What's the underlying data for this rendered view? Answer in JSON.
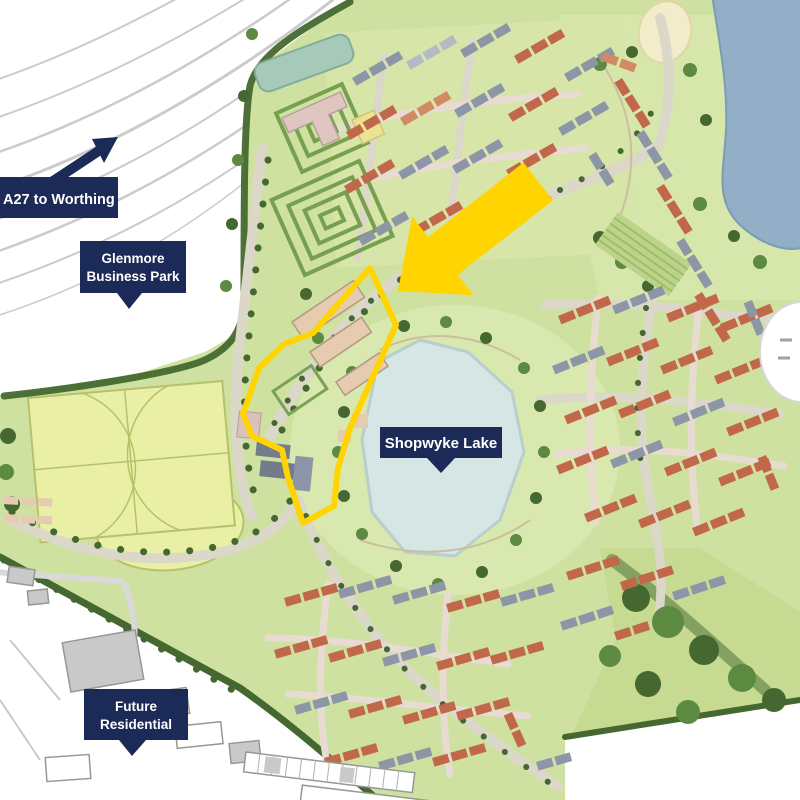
{
  "map": {
    "labels": {
      "a27": {
        "text": "A27 to Worthing"
      },
      "glenmore": {
        "line1": "Glenmore",
        "line2": "Business Park"
      },
      "shopwyke": {
        "text": "Shopwyke Lake"
      },
      "future": {
        "line1": "Future",
        "line2": "Residential"
      }
    },
    "markers": {
      "direction_arrow": "navy-arrow-northeast-along-a27",
      "site_arrow": "yellow-block-arrow-southwest",
      "site_boundary": "yellow-outlined-site"
    },
    "features": {
      "small_lake": "shopwyke-lake",
      "large_lake": "northeast-lake",
      "sports_pitches": "playing-fields",
      "existing_area": "existing-buildings-southwest",
      "main_road": "a27-dual-carriageway"
    },
    "colors": {
      "label_background": "#1c2a57",
      "label_text": "#ffffff",
      "highlight_yellow": "#ffd400",
      "small_lake_fill": "#d6e6e4",
      "large_lake_fill": "#92afc7",
      "greenspace_base": "#cfe1a0",
      "pitch_fill": "#e9f0a6",
      "roof_terracotta": "#c2684a",
      "roof_gray": "#8c96a7",
      "road_fill": "#dcd8c9"
    }
  }
}
